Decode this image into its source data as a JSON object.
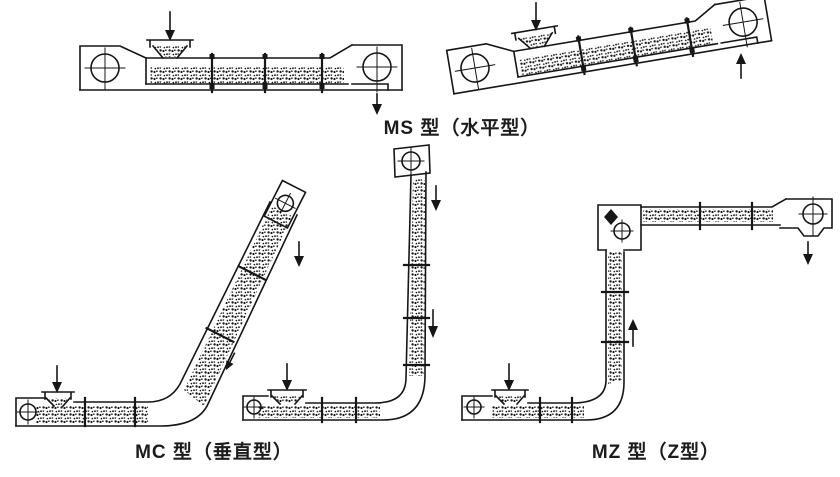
{
  "figure": {
    "background": "#ffffff",
    "ink": "#161616",
    "labels": {
      "ms": "MS 型（水平型）",
      "mc": "MC 型（垂直型）",
      "mz": "MZ 型（Z型）"
    }
  }
}
